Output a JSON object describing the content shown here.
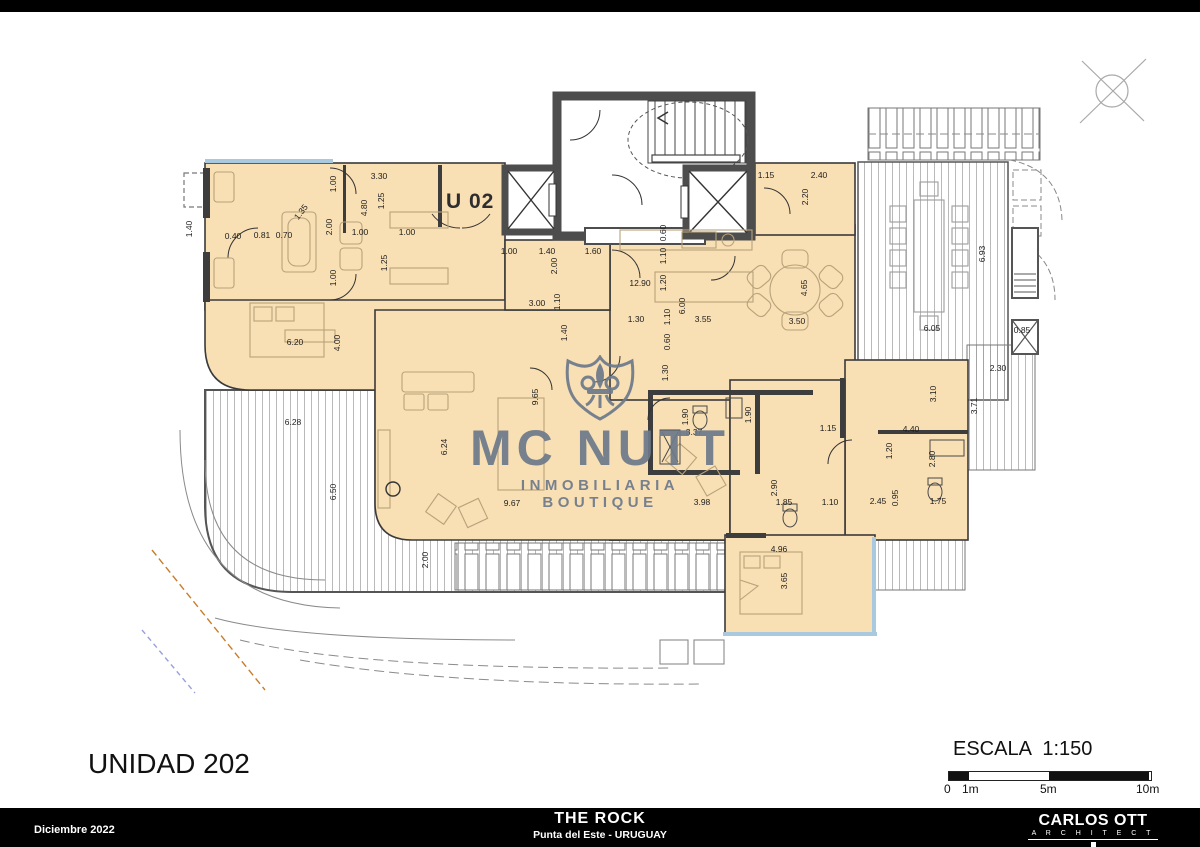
{
  "meta": {
    "unit_title": "UNIDAD 202",
    "unit_tag": "U 02",
    "scale_label": "ESCALA 1:150"
  },
  "scalebar": {
    "ticks": [
      {
        "t": "0",
        "x": 4
      },
      {
        "t": "1m",
        "x": 22
      },
      {
        "t": "5m",
        "x": 100
      },
      {
        "t": "10m",
        "x": 196
      }
    ]
  },
  "watermark": {
    "line1": "MC NUTT",
    "line2": "INMOBILIARIA BOUTIQUE",
    "icon": "fleur-de-lis-shield",
    "color": "#6d7a8b"
  },
  "footer": {
    "date": "Diciembre 2022",
    "project": "THE ROCK",
    "location": "Punta del Este - URUGUAY",
    "architect": "CARLOS OTT",
    "architect_sub": "A R C H I T E C T"
  },
  "colors": {
    "floor": "#f8dfb4",
    "wall_dark": "#4d4d4d",
    "line": "#333333",
    "deck_line": "#9b9b9b",
    "glass": "#a9cade",
    "accent_orange": "#c87d2a",
    "accent_blue": "#97a0dc"
  },
  "dimensions": [
    [
      "1.40",
      189,
      229,
      -90
    ],
    [
      "0.40",
      233,
      236,
      0
    ],
    [
      "0.81",
      262,
      235,
      0
    ],
    [
      "0.70",
      284,
      235,
      0
    ],
    [
      "1.35",
      301,
      212,
      -52
    ],
    [
      "2.00",
      329,
      227,
      -90
    ],
    [
      "1.00",
      333,
      184,
      -90
    ],
    [
      "1.00",
      333,
      278,
      -90
    ],
    [
      "3.30",
      379,
      176,
      0
    ],
    [
      "4.80",
      364,
      208,
      -90
    ],
    [
      "1.25",
      381,
      201,
      -90
    ],
    [
      "1.00",
      360,
      232,
      0
    ],
    [
      "1.00",
      407,
      232,
      0
    ],
    [
      "1.25",
      384,
      263,
      -90
    ],
    [
      "1.00",
      509,
      251,
      0
    ],
    [
      "1.40",
      547,
      251,
      0
    ],
    [
      "1.60",
      593,
      251,
      0
    ],
    [
      "2.00",
      554,
      266,
      -90
    ],
    [
      "12.90",
      640,
      283,
      0
    ],
    [
      "3.00",
      537,
      303,
      0
    ],
    [
      "1.10",
      557,
      302,
      -90
    ],
    [
      "1.40",
      564,
      333,
      -90
    ],
    [
      "1.30",
      636,
      319,
      0
    ],
    [
      "0.60",
      663,
      233,
      -90
    ],
    [
      "1.10",
      663,
      256,
      -90
    ],
    [
      "1.20",
      663,
      283,
      -90
    ],
    [
      "6.00",
      682,
      306,
      -90
    ],
    [
      "1.10",
      667,
      317,
      -90
    ],
    [
      "0.60",
      667,
      342,
      -90
    ],
    [
      "3.55",
      703,
      319,
      0
    ],
    [
      "3.50",
      797,
      321,
      0
    ],
    [
      "4.65",
      804,
      288,
      -90
    ],
    [
      "1.30",
      665,
      373,
      -90
    ],
    [
      "1.15",
      766,
      175,
      0
    ],
    [
      "2.40",
      819,
      175,
      0
    ],
    [
      "2.20",
      805,
      197,
      -90
    ],
    [
      "6.93",
      982,
      254,
      -90
    ],
    [
      "6.05",
      932,
      328,
      0
    ],
    [
      "2.30",
      998,
      368,
      0
    ],
    [
      "3.71",
      974,
      406,
      -90
    ],
    [
      "0.85",
      1022,
      330,
      0
    ],
    [
      "3.10",
      933,
      394,
      -90
    ],
    [
      "4.40",
      911,
      429,
      0
    ],
    [
      "1.20",
      889,
      451,
      -90
    ],
    [
      "2.80",
      932,
      459,
      -90
    ],
    [
      "2.45",
      878,
      501,
      0
    ],
    [
      "0.95",
      895,
      498,
      -90
    ],
    [
      "1.75",
      938,
      501,
      0
    ],
    [
      "1.15",
      828,
      428,
      0
    ],
    [
      "1.90",
      685,
      417,
      -90
    ],
    [
      "3.37",
      694,
      432,
      0
    ],
    [
      "1.90",
      748,
      415,
      -90
    ],
    [
      "3.98",
      702,
      502,
      0
    ],
    [
      "2.90",
      774,
      488,
      -90
    ],
    [
      "1.85",
      784,
      502,
      0
    ],
    [
      "1.10",
      830,
      502,
      0
    ],
    [
      "4.96",
      779,
      549,
      0
    ],
    [
      "3.65",
      784,
      581,
      -90
    ],
    [
      "6.20",
      295,
      342,
      0
    ],
    [
      "4.00",
      337,
      343,
      -90
    ],
    [
      "6.28",
      293,
      422,
      0
    ],
    [
      "6.50",
      333,
      492,
      -90
    ],
    [
      "6.24",
      444,
      447,
      -90
    ],
    [
      "9.65",
      535,
      397,
      -90
    ],
    [
      "9.67",
      512,
      503,
      0
    ],
    [
      "2.00",
      425,
      560,
      -90
    ]
  ]
}
